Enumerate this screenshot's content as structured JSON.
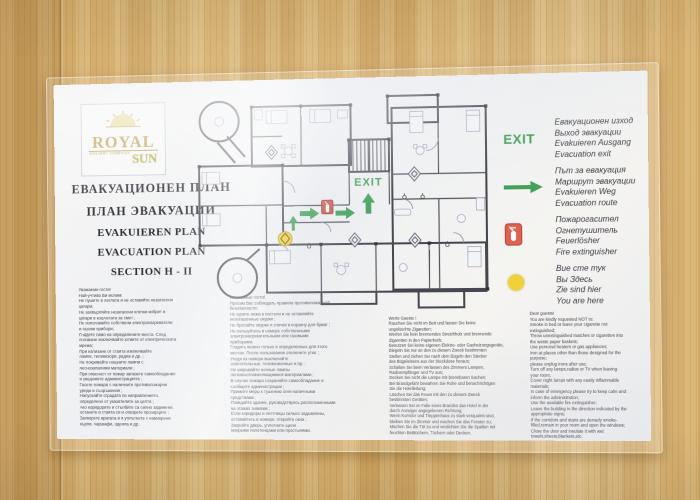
{
  "poster": {
    "logo": {
      "brand": "ROYAL",
      "tagline": "HOLIDAY COMPLEX",
      "brand2": "SUN"
    },
    "titles": [
      "ЕВАКУАЦИОНЕН ПЛАН",
      "ПЛАН ЭВАКУАЦИИ",
      "EVAKUIEREN PLAN",
      "EVACUATION PLAN",
      "SECTION H - II"
    ],
    "plan": {
      "exit_label": "EXIT"
    },
    "legend": {
      "exit_symbol": "EXIT",
      "items": [
        {
          "symbol": "exit-text",
          "lines": [
            "Евакуационен изход",
            "Выход эвакуации",
            "Evakuieren Ausgang",
            "Evacuation exit"
          ]
        },
        {
          "symbol": "evacuation-route-arrow",
          "lines": [
            "Път за евакуация",
            "Маршрут эвакуации",
            "Evakuieren Weg",
            "Evacuation route"
          ]
        },
        {
          "symbol": "fire-extinguisher",
          "lines": [
            "Пожарогасител",
            "Огнетушитель",
            "Feuerlösher",
            "Fire extinguisher"
          ]
        },
        {
          "symbol": "you-are-here-dot",
          "lines": [
            "Вие сте тук",
            "Вы Здесь",
            "Zie sind hier",
            "You are here"
          ]
        }
      ]
    },
    "notes": {
      "bulgarian": [
        "Уважаеми гости!",
        "Най-учтиво Ви молим:",
        "Не пушете в леглата и не оставяйте незагасени",
        "цигари;",
        "Не захвърляйте незагасени клечки кибрит и",
        "цигари в кошчетата за смет ;",
        "Не използвайте собствени електронагреватели",
        "и газови прибори;",
        "Гладете само на определените места. След",
        "ползване изключвайте ютиите от електрическата",
        "мрежа;",
        "При излизане от стаята изключвайте",
        "лампи, телевизори, радиа и др. ;",
        "Не покривайте нощните лампи с",
        "леснозапалими материали ;",
        "При опасност от пожар запазете самообладание",
        "и уведомете администрацията ;",
        "Гасете пожара с наличните противопожарни",
        "уреди и съоръжения ;",
        "Напускайте сградата по направлението,",
        "определено от указателите за целта ;",
        "Ако коридорите и стълбите са силно задимени,",
        "останете в стаята си и отворете прозорците ;",
        "Затворете вратата и я уплътнете с намокрени",
        "кърпи, чаршафи, одеяла и др."
      ],
      "russian": [
        "Уважаемые гости!",
        "Просим Вас соблюдать правила противопожарной",
        "безопасности:",
        "Не курите лежа в постели и не оставляйте",
        "непогашенные окурки ;",
        "Не бросайте окурки и спички в корзину для бумаг ;",
        "Не пользуйтесь в номере собственными",
        "электронагревательными или газовыми",
        "приборами;",
        "Гладить можно только в определенных для этого",
        "местах. После пользования отключите утюг ;",
        "Уходя из номера выключайте",
        "осветительные, телевизионные и пр. ;",
        "Не закрывайте ночные лампы",
        "легковоспламеняющимися материалами ;",
        "В случае пожара сохраняйте самообладание и",
        "сообщите администрации ;",
        "Примите меры  к тушению огня наличными",
        "средствами ;",
        "Покидайте здание, руководствуясь расположенными",
        "на этажах знаками ;",
        "Если коридоры  и лестницы  сильно задымлены,",
        "оставайтесь в номере, откройте окна ;",
        "Закройте дверь, уплотните щели",
        "мокрыми полотенцами или простынями."
      ],
      "german": [
        "Werte Gaeste !",
        "Rauchen Sie nicht im Bett und lassen Sie keine",
        "ungelöschte Zigaretten;",
        "Werfen Sie kein brennendes Streichholz und brennende",
        "Zigaretten in den Papierkorb;",
        "Benutzen Sei keine eigenen Elektro- oder Gasheizungsgeräte,",
        "Biegeln Sie nur an den zu diesem Zweck bestimmten",
        "Stellen und ziehen Sei nach dem Bügeln den Stecker",
        "des Bügeleisens aus der Steckdose heraus;",
        "Schalten Sei beim Verlassen des Zimmers Lampen,",
        "Radioempfänger und TV aus;",
        "Decken Sei nicht die Lampe mit brennbaren  Sachen;",
        "Bei Brandgefahr bewahren Sie Ruhe und benachrichtigen",
        "Sie die Hotelleitung;",
        "Löschen Sei das Feuer mit den zu diesem Zweck",
        "bestimmten Geräten;",
        "Verlassen Sei im Falle eines Brandes das Hotel in der",
        "durch Anzeiger angegebenen Richtung;",
        "Wenn Korridor und Treppenhaus zu stark  verqualmt sind,",
        "bleiben Sie im Zimmer und machen Sie das Fenster zu;",
        "Machen Sie die Tür zu und verdichten Sie die Spalten mit",
        "feuchten Betttüchern, Tüchern oder Decken."
      ],
      "english": [
        "Dear guests!",
        "You are kindly requested NOT to:",
        "Smoke in bed or leave your cigarette not",
        "extinguished;",
        "Throw unextinguished matches or cigarettes into",
        "the waste paper baskets;",
        "Use personal heaters or gas appliances;",
        "Iron at places other than those designed for the",
        "purpose;",
        "please unplug irons after use;",
        "Turn off any lamps,radios or TV when leaving",
        "your room;",
        "Cover night lamps with any easily inflammable",
        "materials;",
        "In case of emergency please try to keep calm and",
        "inform the administration;",
        "Use the available fire extinguisher;",
        "Leave the building in the direction indicated by the",
        "appropriate signs;",
        "If the corridors and stairs are densely smoke-",
        "filled,remain in your room and open the windows;",
        "Close the door and insulate it with wet",
        "towels,sheets,blankets,etc."
      ]
    },
    "colors": {
      "exit_green": "#3f9e53",
      "extinguisher_red": "#d05848",
      "marker_yellow": "#f1d13a",
      "wood": "#d2a965"
    }
  }
}
